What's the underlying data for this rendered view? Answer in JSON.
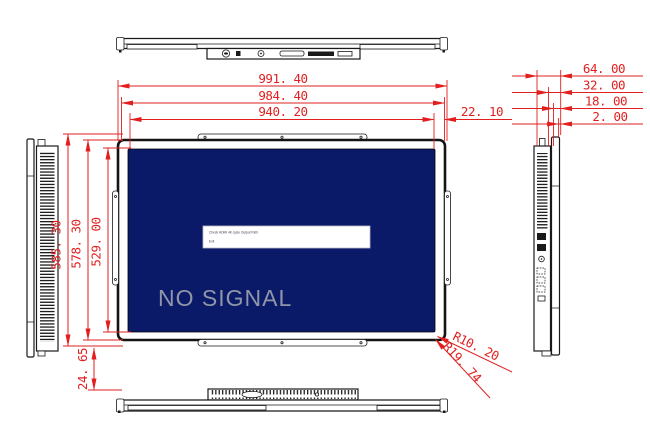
{
  "dims": {
    "width_overall": "991. 40",
    "width_frame": "984. 40",
    "width_active": "940. 20",
    "border_right": "22. 10",
    "depth_overall": "64. 00",
    "depth_body": "32. 00",
    "depth_inner": "18. 00",
    "depth_glass": "2. 00",
    "height_overall": "585. 30",
    "height_frame": "578. 30",
    "height_active": "529. 00",
    "border_bottom": "24. 65",
    "radius_inner": "R10. 20",
    "radius_outer": "R19. 74"
  },
  "screen": {
    "no_signal": "NO SIGNAL",
    "osd_line1": "Check HDMI 4K cycle Output Path",
    "osd_line2": "Exit"
  },
  "colors": {
    "dimension_red": "#e21f1f",
    "outline_black": "#1a1a1a",
    "screen_blue": "#0a1a68",
    "no_signal_gray": "#9096a8"
  }
}
